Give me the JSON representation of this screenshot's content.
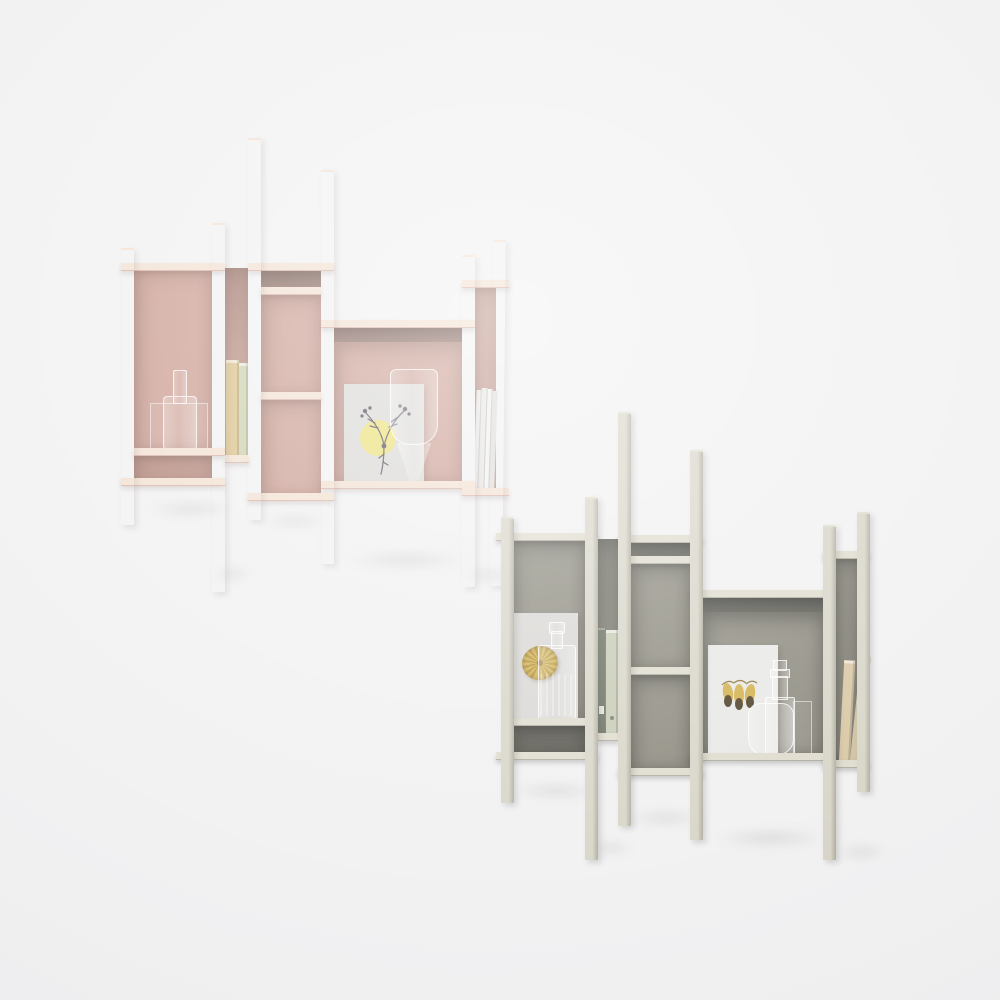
{
  "scene": {
    "type": "product-photo",
    "subject": "two asymmetric wall-mounted bookcases with decor objects"
  },
  "colors": {
    "background": "#f1f1f2",
    "pink_face": "#eed8c9",
    "pink_face_shade": "#d8b2a3",
    "pink_shelf": "#f2e0d1",
    "pink_back": "#cb9e92",
    "pink_back_low": "#bb8e82",
    "pink_dark": "#6e534d",
    "pink_slot": "#a97f74",
    "grey_face": "#d8d5c8",
    "grey_face_shade": "#b0ad9f",
    "grey_shelf": "#dfdcce",
    "grey_back": "#8e8c80",
    "grey_back_low": "#5e5d55",
    "grey_dark": "#434340",
    "grey_slot": "#77766b",
    "gold": "#d3b14d",
    "yellow_circle": "#eadf75",
    "paper_grey": "#d8d7d4",
    "paper_white": "#e8e8e6",
    "botanical_ink": "#4c4652",
    "book_tan": "#d9c188",
    "book_sage": "#ccd0ad",
    "binder_dark": "#6b7263",
    "binder_light": "#c6cbb4",
    "book_beige": "#d9c8a5",
    "book_cream": "#cfc2a2",
    "magazine_white": "#f0f0ee",
    "glass_line": "rgba(255,255,255,0.75)"
  },
  "units": [
    {
      "id": "bookcase-pink",
      "finish": "blush-pink",
      "objects": [
        "glass-bottle",
        "two-books",
        "art-print-botanical-yellow-circle",
        "glass-vase",
        "white-magazines"
      ]
    },
    {
      "id": "bookcase-grey",
      "finish": "grey-green",
      "objects": [
        "art-print-gold-fan",
        "glass-bottle",
        "ring-binders",
        "art-print-gold-ornaments",
        "glass-decanters",
        "beige-books"
      ]
    }
  ]
}
